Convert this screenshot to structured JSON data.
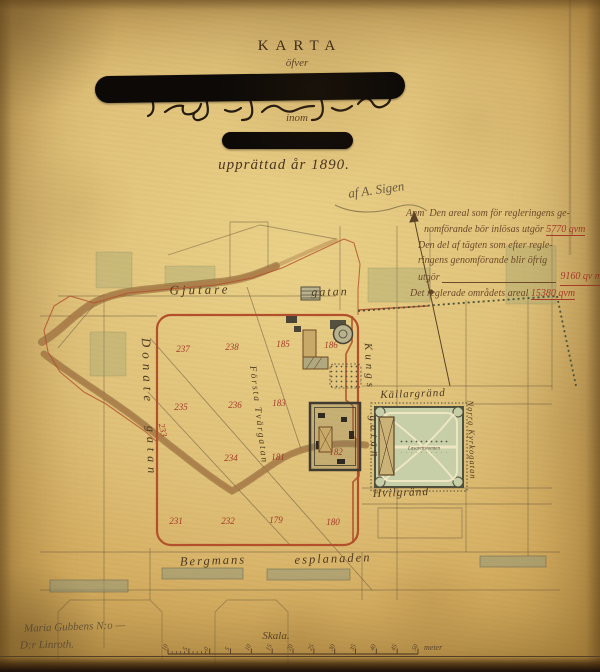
{
  "title": {
    "main": "KARTA",
    "ofver": "öfver",
    "inom": "inom",
    "date_line": "upprättad år 1890.",
    "signature": "af A. Sigen"
  },
  "annotation": {
    "lines": [
      {
        "pre": "Anm  Den areal som för regleringens ge-",
        "num": ""
      },
      {
        "pre": "nomförande bör inlösas utgör ",
        "num": "5770 qvm"
      },
      {
        "pre": "Den del af tägten som efter regle-",
        "num": ""
      },
      {
        "pre": "ringens genomförande blir öfrig",
        "num": ""
      },
      {
        "pre": "utgör",
        "num": "9160 qv m",
        "fill": true
      },
      {
        "pre": "Det reglerade områdets areal ",
        "num": "15380 qvm"
      }
    ]
  },
  "map": {
    "street_labels": [
      {
        "text": "Gjutare",
        "x": 200,
        "y": 290,
        "rot": -1,
        "size": 13,
        "ls": 3
      },
      {
        "text": "gatan",
        "x": 330,
        "y": 292,
        "rot": -1,
        "size": 12,
        "ls": 2
      },
      {
        "text": "Donate",
        "x": 147,
        "y": 372,
        "rot": 88,
        "size": 13,
        "ls": 5
      },
      {
        "text": "gatan",
        "x": 151,
        "y": 452,
        "rot": 88,
        "size": 12,
        "ls": 5
      },
      {
        "text": "Första Tvärgatan",
        "x": 258,
        "y": 415,
        "rot": 83,
        "size": 9.5,
        "ls": 2
      },
      {
        "text": "Kungs",
        "x": 369,
        "y": 367,
        "rot": 87,
        "size": 11,
        "ls": 4
      },
      {
        "text": "gatan",
        "x": 374,
        "y": 438,
        "rot": 87,
        "size": 11,
        "ls": 4
      },
      {
        "text": "Källargränd",
        "x": 413,
        "y": 394,
        "rot": -2,
        "size": 11,
        "ls": 1
      },
      {
        "text": "Norra Kyrkogatan",
        "x": 472,
        "y": 440,
        "rot": 88,
        "size": 8.5,
        "ls": 1
      },
      {
        "text": "Hvilgränd",
        "x": 401,
        "y": 493,
        "rot": -2,
        "size": 11.5,
        "ls": 1
      },
      {
        "text": "Bergmans",
        "x": 213,
        "y": 561,
        "rot": -2,
        "size": 12.5,
        "ls": 2
      },
      {
        "text": "esplanaden",
        "x": 333,
        "y": 559,
        "rot": -2,
        "size": 12.5,
        "ls": 2
      }
    ],
    "plot_numbers": [
      {
        "n": "237",
        "x": 183,
        "y": 349
      },
      {
        "n": "238",
        "x": 232,
        "y": 347
      },
      {
        "n": "185",
        "x": 283,
        "y": 344
      },
      {
        "n": "186",
        "x": 331,
        "y": 345
      },
      {
        "n": "235",
        "x": 181,
        "y": 407
      },
      {
        "n": "236",
        "x": 235,
        "y": 405
      },
      {
        "n": "183",
        "x": 279,
        "y": 403
      },
      {
        "n": "233",
        "x": 163,
        "y": 430,
        "rot": 78
      },
      {
        "n": "234",
        "x": 231,
        "y": 458
      },
      {
        "n": "181",
        "x": 278,
        "y": 457
      },
      {
        "n": "182",
        "x": 336,
        "y": 452
      },
      {
        "n": "231",
        "x": 176,
        "y": 521
      },
      {
        "n": "232",
        "x": 228,
        "y": 521
      },
      {
        "n": "179",
        "x": 276,
        "y": 520
      },
      {
        "n": "180",
        "x": 333,
        "y": 522
      }
    ],
    "park_label": "Lasarettstomten"
  },
  "scale": {
    "label": "Skala.",
    "unit": "meter",
    "ticks": [
      "10",
      "5",
      "0",
      "5",
      "10",
      "15",
      "20",
      "25",
      "30",
      "35",
      "40",
      "45",
      "50"
    ]
  },
  "footer_notes": {
    "line1": "Maria Gubbens N:o —",
    "line2": "D:r Linroth."
  },
  "colors": {
    "paper": "#ddbb74",
    "ink": "#5b4226",
    "regulation_red": "#b2502c",
    "number_red": "#a33a28",
    "park_green": "#c6cfa8",
    "road_brown": "#ad7f4a",
    "redaction_black": "#0c0907"
  }
}
